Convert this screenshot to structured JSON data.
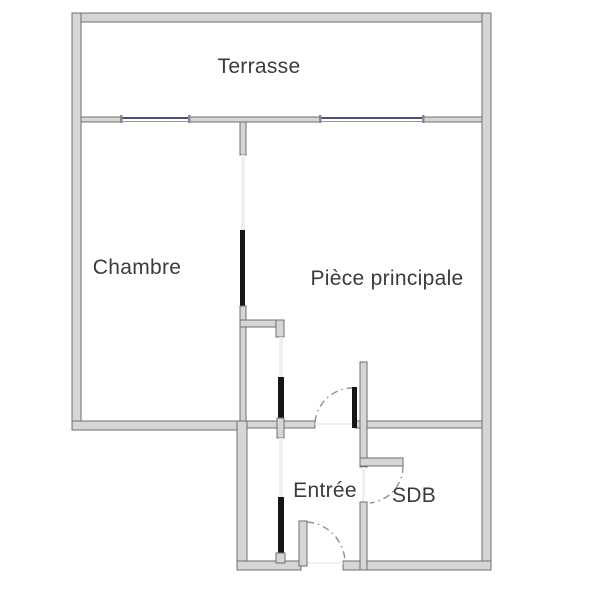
{
  "plan": {
    "type": "apartment-floor-plan",
    "rooms": [
      {
        "id": "terrasse",
        "label": "Terrasse"
      },
      {
        "id": "chambre",
        "label": "Chambre"
      },
      {
        "id": "piece-principale",
        "label": "Pièce principale"
      },
      {
        "id": "entree",
        "label": "Entrée"
      },
      {
        "id": "sdb",
        "label": "SDB"
      }
    ],
    "features": {
      "windows_on_terrace_wall": 2,
      "hinged_door_swings": 3,
      "sliding_door_leaves": 2
    }
  },
  "colors": {
    "background": "#ffffff",
    "wall_fill": "#d6d6d6",
    "wall_outline": "#6f6f6f",
    "window_line": "#46527c",
    "door_leaf": "#161616",
    "swing_arc": "#8f8f8f",
    "opening_guide": "#efefef",
    "label_text": "#3b3b3b"
  }
}
